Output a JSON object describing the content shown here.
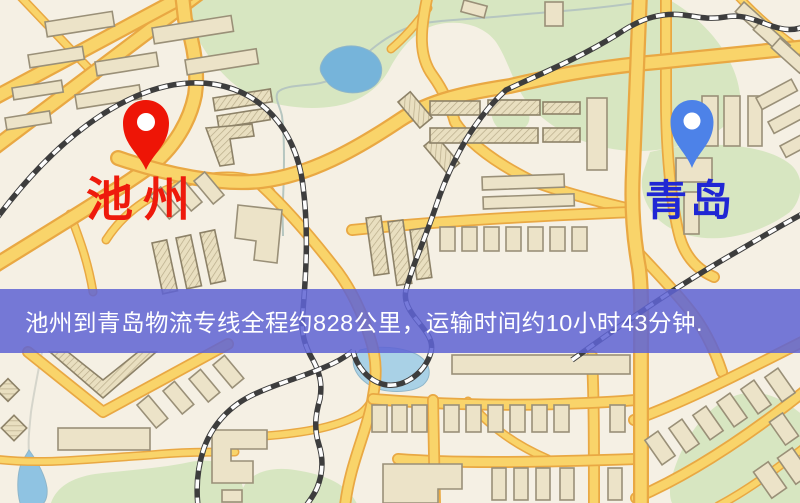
{
  "banner": {
    "text": "池州到青岛物流专线全程约828公里，运输时间约10小时43分钟.",
    "background_color": "#5f64d4",
    "text_color": "#ffffff"
  },
  "route": {
    "origin": "池州",
    "destination": "青岛",
    "distance": "约828公里",
    "duration": "约10小时43分钟"
  },
  "markers": [
    {
      "id": "origin",
      "label": "池州",
      "pin_color": "#ee1506",
      "label_color": "#ee1a0c"
    },
    {
      "id": "destination",
      "label": "青岛",
      "pin_color": "#4d82e8",
      "label_color": "#2027d4"
    }
  ],
  "map_palette": {
    "background": "#f5f0e4",
    "road_fill": "#f9d46a",
    "road_casing": "#e9a843",
    "building": "#ece3c8",
    "park_green": "#d7e6c1",
    "water_blue": "#76b4da",
    "railway": "#3d3d3d"
  }
}
